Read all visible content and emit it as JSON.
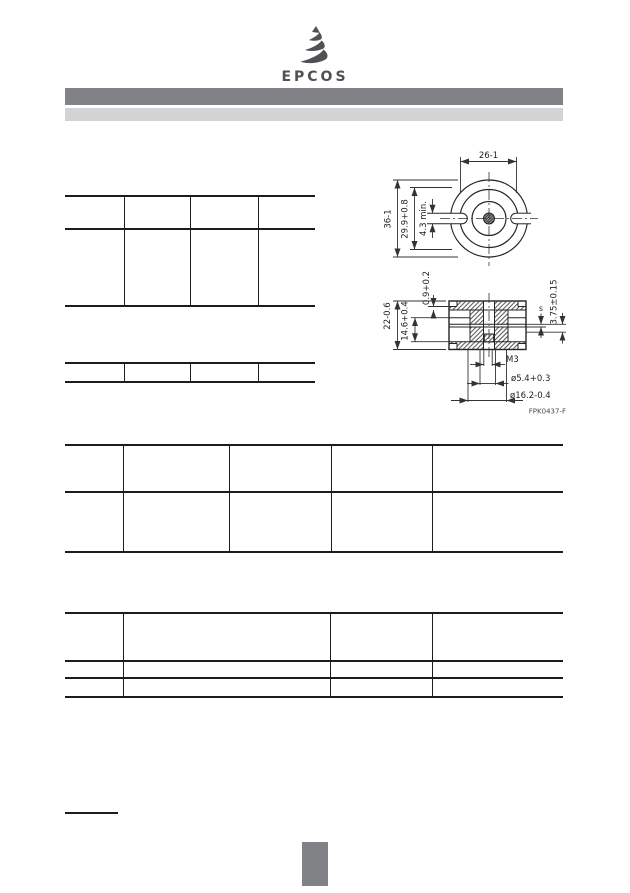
{
  "page": {
    "background": "#ffffff"
  },
  "logo": {
    "brand": "EPCOS",
    "color": "#4f5155"
  },
  "header": {
    "bar_primary_color": "#808285",
    "bar_secondary_color": "#d1d3d4"
  },
  "drawing": {
    "top_view": {
      "dim_notch_width": "26-1",
      "dim_outer_diameter": "36-1",
      "dim_inner_diameter": "29.9+0.8",
      "dim_slot": "4.3 min."
    },
    "section_view": {
      "dim_rim_step": "0.9+0.2",
      "dim_height": "22-0.6",
      "dim_slot_width": "14.6+0.4",
      "dim_gap": "s",
      "dim_depth": "3.75±0.15",
      "thread_label": "M3",
      "dim_hole_diameter": "ø5.4+0.3",
      "dim_center_diameter": "ø16.2-0.4"
    },
    "figure_code": "FPK0437-F"
  },
  "footer": {
    "page_marker_color": "#808285"
  }
}
